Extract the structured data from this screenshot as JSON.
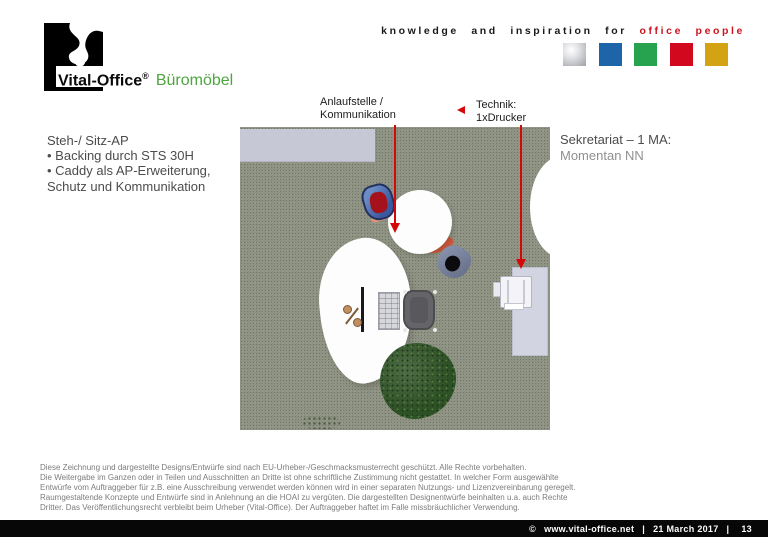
{
  "header": {
    "logo": {
      "brand": "Vital-Office",
      "registered": "®",
      "product_line": "Büromöbel",
      "product_line_color": "#4fa53f"
    },
    "tagline": {
      "prefix": "knowledge and inspiration for",
      "highlight": "office people",
      "highlight_color": "#cc1420"
    },
    "palette_squares": [
      {
        "name": "silver",
        "color": "#c2c3c8"
      },
      {
        "name": "blue",
        "color": "#1e64a8"
      },
      {
        "name": "green",
        "color": "#27a24f"
      },
      {
        "name": "red",
        "color": "#d2091e"
      },
      {
        "name": "gold",
        "color": "#d4a313"
      }
    ]
  },
  "notes_left": {
    "title": "Steh-/ Sitz-AP",
    "lines": [
      "•  Backing durch STS 30H",
      "•  Caddy als AP-Erweiterung,",
      "Schutz und Kommunikation"
    ]
  },
  "annotations": {
    "communication": {
      "line1": "Anlaufstelle /",
      "line2": "Kommunikation"
    },
    "technik": {
      "line1": "Technik:",
      "line2": "1xDrucker"
    },
    "arrow_color": "#d40808"
  },
  "notes_right": {
    "line1": "Sekretariat – 1 MA:",
    "line2": "Momentan NN"
  },
  "floorplan": {
    "carpet_color": "#8e9283",
    "wall_color": "#c7c8d5"
  },
  "legal": {
    "lines": [
      "Diese Zeichnung und dargestellte Designs/Entwürfe sind nach EU-Urheber-/Geschmacksmusterrecht geschützt. Alle Rechte vorbehalten.",
      "Die Weitergabe im Ganzen oder in Teilen und Ausschnitten an Dritte ist ohne schriftliche Zustimmung nicht gestattet. In welcher Form ausgewählte",
      "Entwürfe vom Auftraggeber für z.B. eine Ausschreibung verwendet werden können wird in einer separaten Nutzungs- und Lizenzvereinbarung geregelt.",
      "Raumgestaltende Konzepte und Entwürfe sind in Anlehnung an die HOAI zu vergüten. Die dargestellten Designentwürfe beinhalten u.a. auch Rechte",
      "Dritter. Das Veröffentlichungsrecht verbleibt beim Urheber (Vital-Office). Der Auftraggeber haftet im Falle missbräuchlicher Verwendung."
    ]
  },
  "footer": {
    "copyright": "©",
    "website": "www.vital-office.net",
    "separator": "|",
    "date": "21 March 2017",
    "page": "13"
  }
}
